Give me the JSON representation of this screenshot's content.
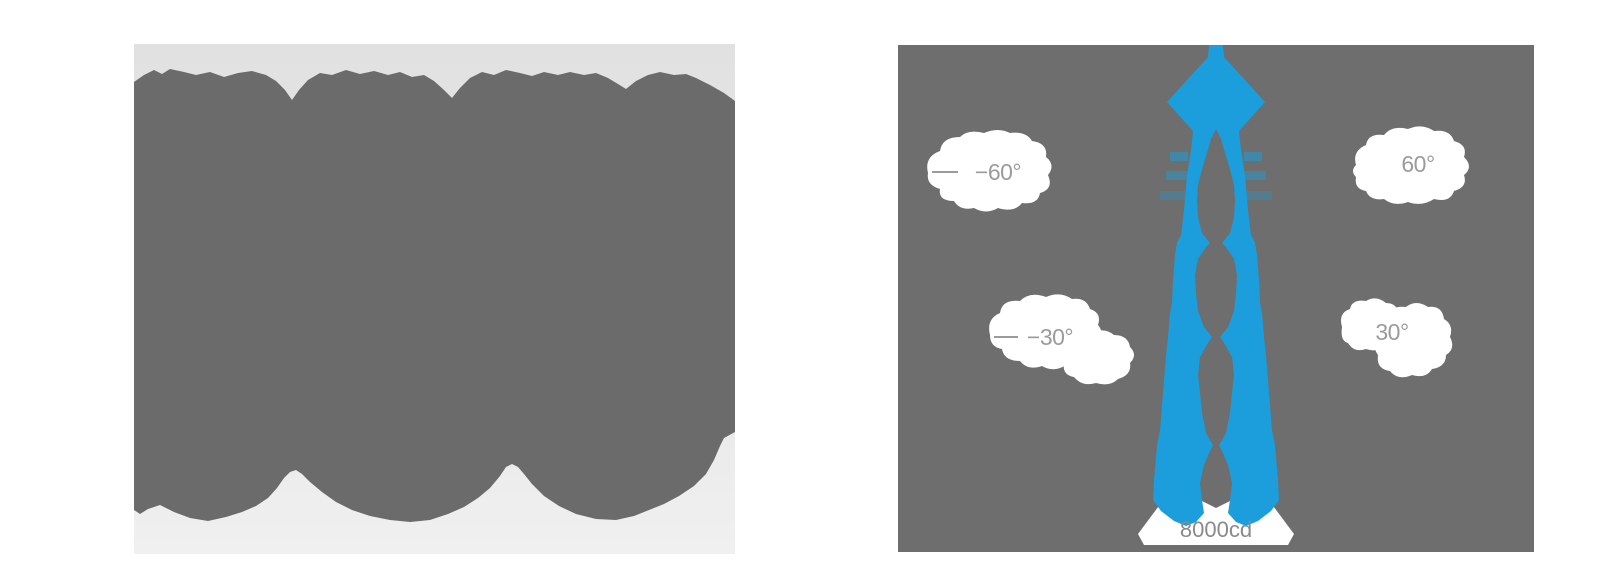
{
  "page": {
    "background": "#ffffff",
    "description_left": "blurred product image",
    "description_right": "photometric polar intensity diagram"
  },
  "left_image": {
    "bg_top": "#e1e1e1",
    "bg_bottom": "#f0f0f0",
    "blob_color": "#6b6b6b"
  },
  "polar_diagram": {
    "background": "#6e6e6e",
    "beam_color": "#1b9edb",
    "callout_color": "#ffffff",
    "label_color": "#9b9b9b",
    "candela_color": "#8a8a8a",
    "labels": {
      "left60": "−60°",
      "right60": "60°",
      "left30": "−30°",
      "right30": "30°",
      "candela": "8000cd"
    }
  },
  "chart_data": {
    "type": "area",
    "subtype": "polar luminous intensity distribution (luminaire light output curve)",
    "title": "",
    "angle_ticks_deg": [
      -60,
      -30,
      30,
      60
    ],
    "angle_tick_labels": [
      "−60°",
      "−30°",
      "30°",
      "60°"
    ],
    "radial_scale_max_label": "8000cd",
    "radial_scale_max_cd": 8000,
    "series": [
      {
        "name": "luminous intensity",
        "color": "#1b9edb",
        "beam_description": "very narrow symmetric spot beam centered on 0° (straight down axis), peak near 8000 cd",
        "approx_beam_halfwidth_deg": 10
      }
    ],
    "legend": "none",
    "grid": "angle callouts at ±30° and ±60°; bottom intensity ring labeled 8000cd"
  }
}
